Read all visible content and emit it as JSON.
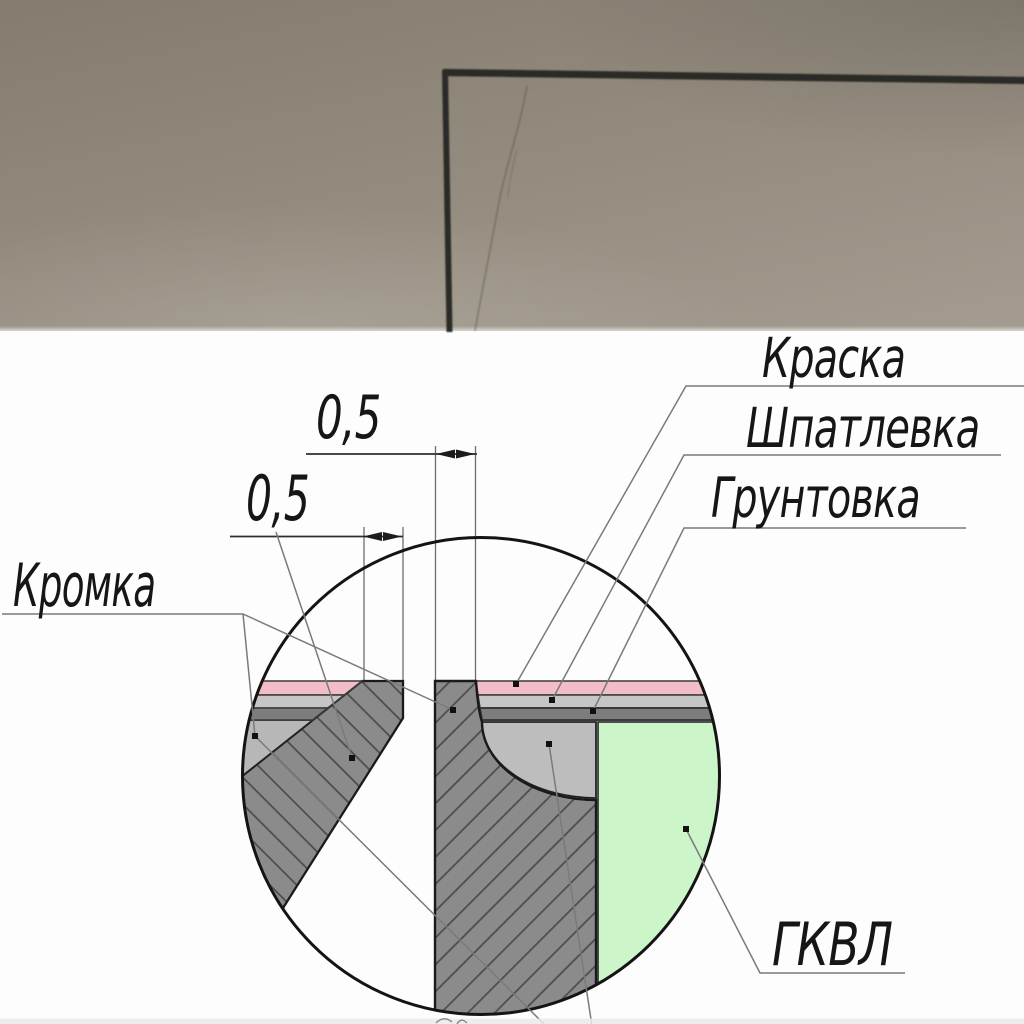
{
  "labels": {
    "paint": "Краска",
    "putty": "Шпатлевка",
    "primer": "Грунтовка",
    "edge": "Кромка",
    "gkvl_board": "ГКВЛ"
  },
  "dimensions": {
    "joint_reveal": "0,5",
    "edge_flat": "0,5"
  },
  "colors": {
    "paint_layer": "#f2bdc9",
    "putty_layer": "#c6c6c6",
    "primer_layer": "#7d7d7d",
    "board_section_fill": "#8b8b8b",
    "hatch_line": "#4a4a4a",
    "gkvl_fill": "#cdf5ca",
    "putty_fill_quarter": "#bdbdbd",
    "putty_fill_chamfer": "#b7b7b7",
    "photo_surface_dark": "#837c6f",
    "photo_surface_light": "#a49c90",
    "groove_line": "#2b2a26"
  }
}
